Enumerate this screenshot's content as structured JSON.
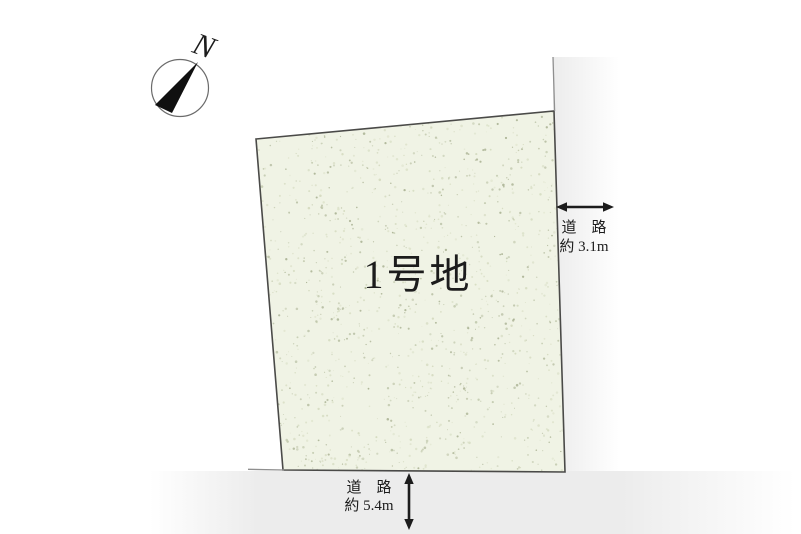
{
  "canvas": {
    "width": 801,
    "height": 534,
    "background": "#ffffff"
  },
  "compass": {
    "north_label": "N"
  },
  "plot": {
    "label": "1号地",
    "speckle_colors": [
      "#c2c9ae",
      "#d4dabf",
      "#aab293",
      "#dde2cb"
    ]
  },
  "roads": {
    "right": {
      "name_label": "道　路",
      "width_label": "約 3.1m"
    },
    "bottom": {
      "name_label": "道　路",
      "width_label": "約 5.4m"
    }
  },
  "colors": {
    "plot_fill": "#f0f3e5",
    "plot_border": "#4a4a48",
    "ink": "#1c1c1c",
    "road_tint": "#ececec",
    "boundary_line": "#8f8f8f"
  }
}
